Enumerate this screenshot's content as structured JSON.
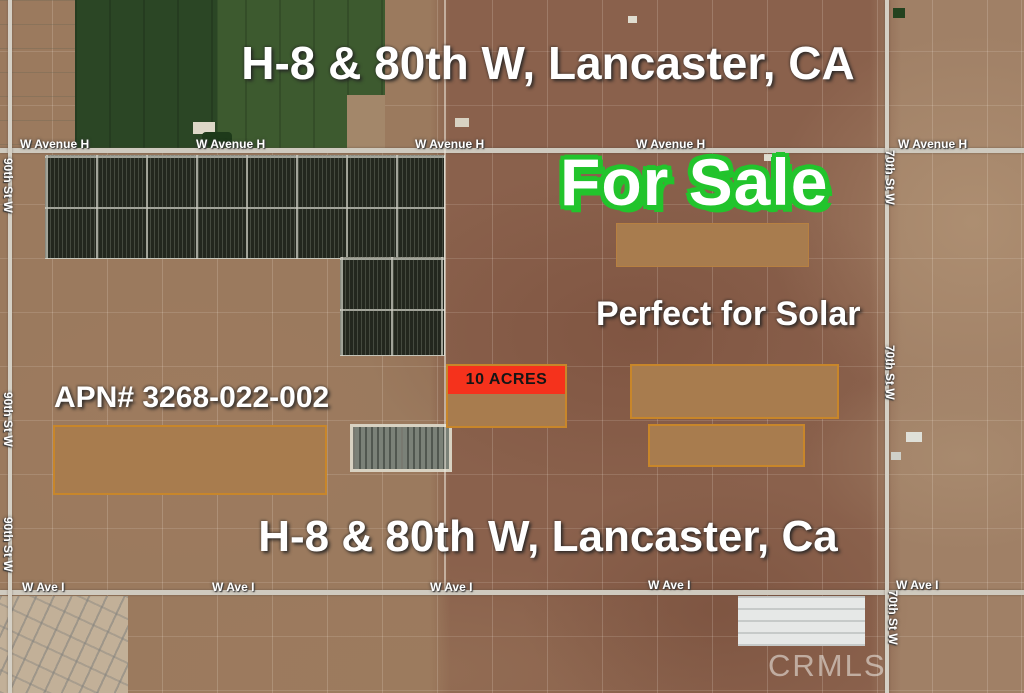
{
  "overlays": {
    "title_top": "H-8 & 80th W, Lancaster, CA",
    "for_sale": "For Sale",
    "tagline": "Perfect for Solar",
    "apn": "APN# 3268-022-002",
    "parcel_size": "10 ACRES",
    "title_bottom": "H-8 & 80th W, Lancaster, Ca",
    "watermark": "CRMLS"
  },
  "roads": {
    "avenue_h": [
      "W Avenue H",
      "W Avenue H",
      "W Avenue H",
      "W Avenue H",
      "W Avenue H"
    ],
    "ave_i": [
      "W Ave I",
      "W Ave I",
      "W Ave I",
      "W Ave I",
      "W Ave I"
    ],
    "st90": [
      "90th St W",
      "90th St W",
      "90th St W"
    ],
    "st70": [
      "70th St W",
      "70th St W",
      "70th St W"
    ]
  },
  "colors": {
    "for_sale_green": "#22c42c",
    "acres_label_red": "#f5321c",
    "parcel_fill_brown": "#a87c4e",
    "parcel_border_orange": "#c8862a",
    "road_gray": "#cfcabf"
  }
}
